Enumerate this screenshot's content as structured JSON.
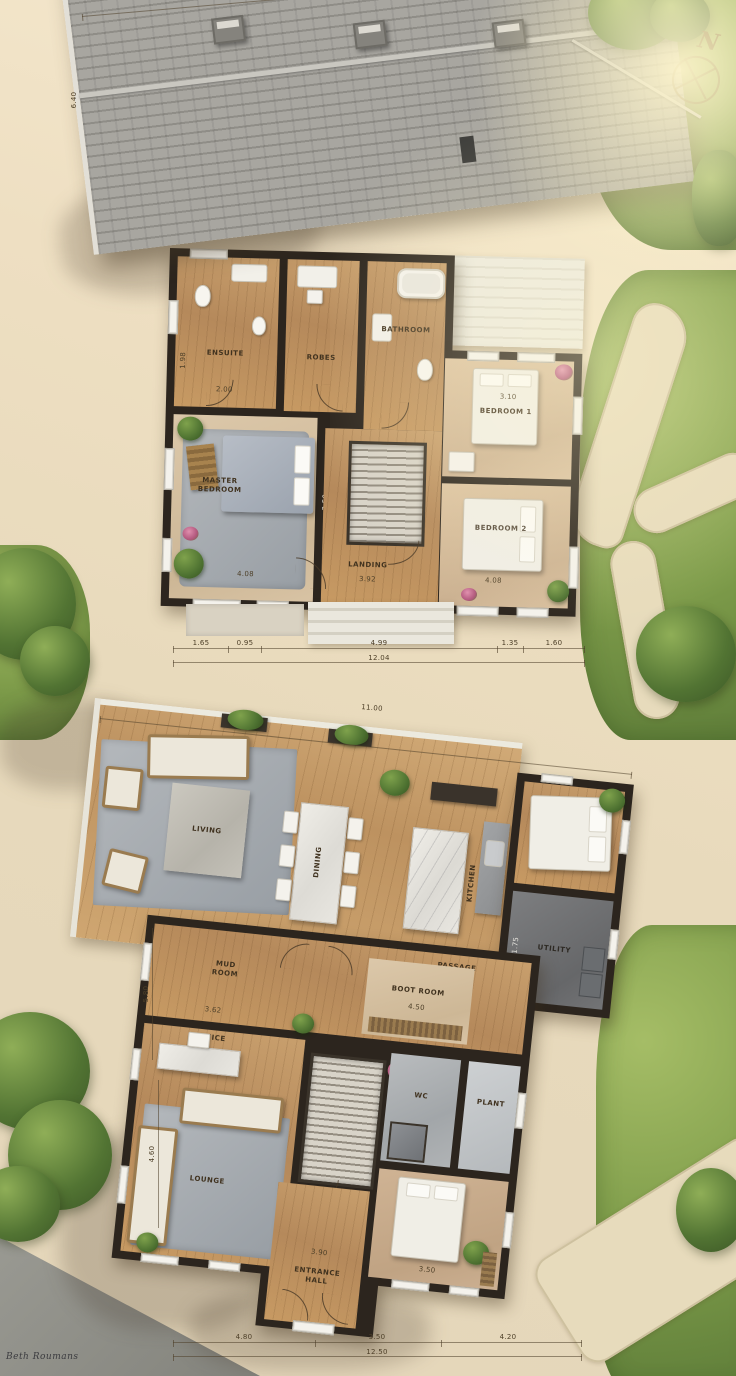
{
  "palette": {
    "wall": "#2c251e",
    "wood": "#c79a63",
    "deck": "#cfa671",
    "grass": "#7e9c4a",
    "roof": "#a8a6a0",
    "rug": "#a6abb1",
    "label_ink": "#40321f"
  },
  "compass": {
    "label": "N"
  },
  "watermark": "Beth Roumans",
  "upper": {
    "dim_top": "11.00",
    "dim_left": "6.40",
    "rooms": {
      "ensuite": {
        "label": "ENSUITE",
        "dim_w": "2.00",
        "dim_h": "1.98"
      },
      "robes": {
        "label": "ROBES"
      },
      "bathroom": {
        "label": "BATHROOM"
      },
      "bedroom1": {
        "label": "BEDROOM 1",
        "dim": "3.10"
      },
      "master": {
        "label": "MASTER\nBEDROOM",
        "dim_w": "4.08",
        "dim_h": "3.50"
      },
      "landing": {
        "label": "LANDING",
        "dim": "3.92"
      },
      "bedroom2": {
        "label": "BEDROOM 2",
        "dim": "4.08"
      }
    },
    "dims_bottom": {
      "segs": [
        "1.65",
        "0.95",
        "4.99",
        "1.35",
        "1.60"
      ],
      "total": "12.04"
    }
  },
  "lower": {
    "dim_top": "11.00",
    "dims_left": {
      "segs": [
        "5.80",
        "4.60"
      ]
    },
    "rooms": {
      "living": {
        "label": "LIVING"
      },
      "dining": {
        "label": "DINING"
      },
      "kitchen": {
        "label": "KITCHEN"
      },
      "utility": {
        "label": "UTILITY",
        "dim_h": "1.75"
      },
      "mudroom": {
        "label": "MUD\nROOM",
        "dim": "3.62"
      },
      "passage": {
        "label": "PASSAGE"
      },
      "bootroom": {
        "label": "BOOT ROOM",
        "dim": "4.50"
      },
      "office": {
        "label": "OFFICE"
      },
      "lounge": {
        "label": "LOUNGE"
      },
      "wc": {
        "label": "WC"
      },
      "plant": {
        "label": "PLANT"
      },
      "bedroom3": {
        "dim": "3.50"
      },
      "entrance": {
        "label": "ENTRANCE\nHALL",
        "dim": "3.90"
      }
    },
    "dims_bottom": {
      "segs": [
        "4.80",
        "3.50",
        "4.20"
      ],
      "total": "12.50"
    }
  }
}
